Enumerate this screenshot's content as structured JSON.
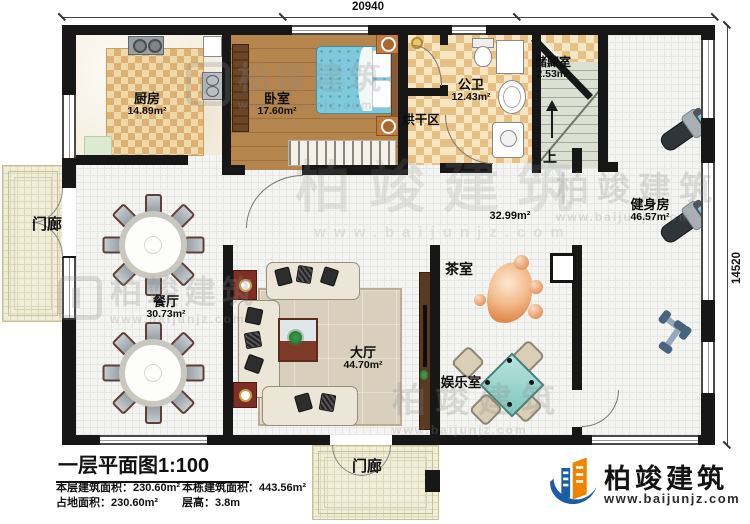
{
  "palette": {
    "wall": "#171717",
    "checker_dark": "#e7c183",
    "checker_light": "#f6e7c2",
    "wood": "#b0804a",
    "bed_blue": "#7fc9db",
    "mahjong_teal": "#9fd8cf",
    "cabinet_red": "#7e2f25",
    "accent_blue": "#1b5ea6",
    "accent_orange": "#f08300"
  },
  "dimensions": {
    "top": "20940",
    "right": "14520"
  },
  "rooms": {
    "kitchen": {
      "name": "厨房",
      "area": "14.89m²"
    },
    "bedroom": {
      "name": "卧室",
      "area": "17.60m²"
    },
    "bathroom": {
      "name": "公卫",
      "area": "12.43m²"
    },
    "storage": {
      "name": "储藏室",
      "area": "2.53m²"
    },
    "drying": {
      "name": "烘干区"
    },
    "gym": {
      "name": "健身房",
      "area": "46.57m²"
    },
    "dining": {
      "name": "餐厅",
      "area": "30.73m²"
    },
    "hall": {
      "name": "大厅",
      "area": "44.70m²"
    },
    "tea": {
      "name": "茶室"
    },
    "entertainment": {
      "name": "娱乐室"
    },
    "corridor": {
      "area": "32.99m²"
    },
    "porch_left": {
      "name": "门廊"
    },
    "porch_bottom": {
      "name": "门廊"
    }
  },
  "stairs": {
    "up_label": "上"
  },
  "title_block": {
    "title": "一层平面图1:100",
    "stat1": "本层建筑面积：230.60m²",
    "stat2": "占地面积：230.60m²",
    "stat3": "本栋建筑面积：443.56m²",
    "stat4": "层高：3.8m"
  },
  "brand": {
    "name": "柏竣建筑",
    "website": "www.baijunjz.com"
  },
  "watermark": {
    "text": "柏竣建筑",
    "sub": "www.baijunjz.com"
  }
}
